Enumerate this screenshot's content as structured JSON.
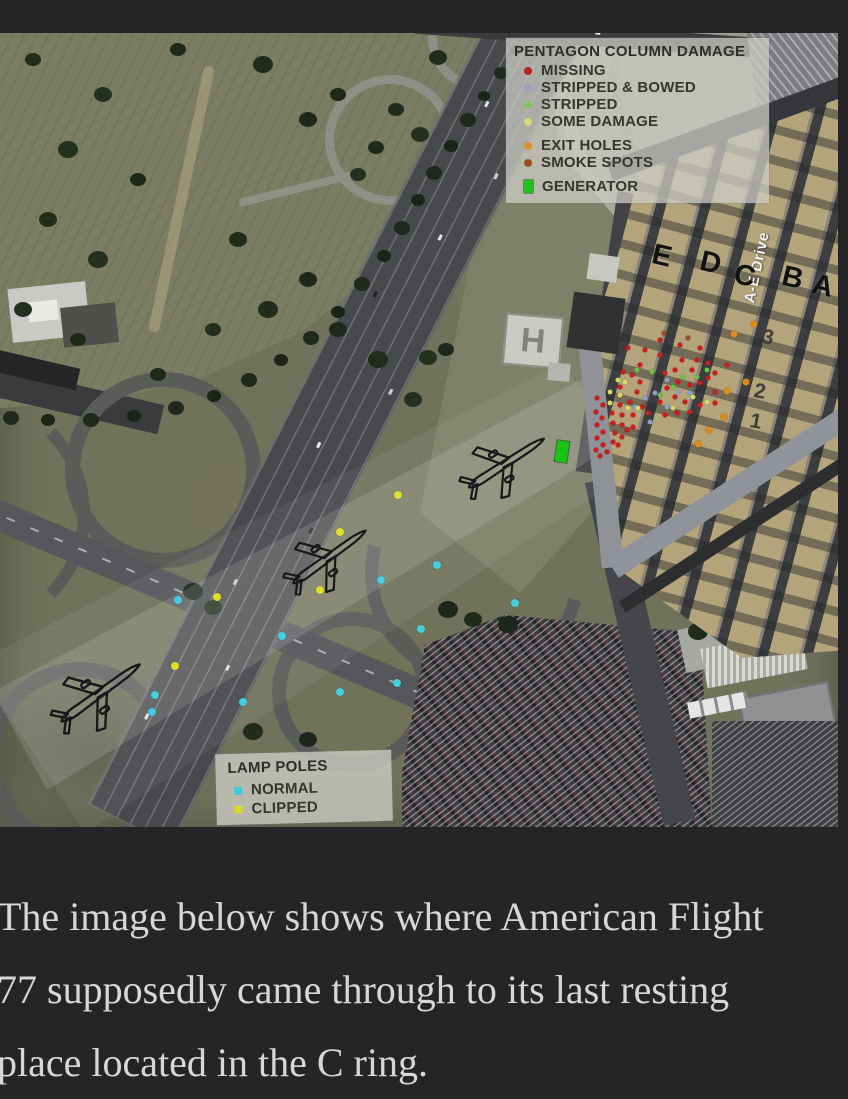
{
  "page": {
    "background": "#262525"
  },
  "figure": {
    "damage_legend": {
      "title": "PENTAGON COLUMN DAMAGE",
      "groups": [
        {
          "items": [
            {
              "label": "MISSING",
              "color": "#bb2026",
              "shape": "circle"
            },
            {
              "label": "STRIPPED & BOWED",
              "color": "#9aa6c0",
              "shape": "circle"
            },
            {
              "label": "STRIPPED",
              "color": "#86c55e",
              "shape": "circle"
            },
            {
              "label": "SOME DAMAGE",
              "color": "#d9d97a",
              "shape": "circle"
            }
          ]
        },
        {
          "items": [
            {
              "label": "EXIT HOLES",
              "color": "#d8912c",
              "shape": "circle"
            },
            {
              "label": "SMOKE SPOTS",
              "color": "#96511f",
              "shape": "circle"
            }
          ]
        },
        {
          "items": [
            {
              "label": "GENERATOR",
              "color": "#1ec41e",
              "shape": "rect"
            }
          ]
        }
      ]
    },
    "lamp_legend": {
      "title": "LAMP POLES",
      "items": [
        {
          "label": "NORMAL",
          "color": "#3ec9d9"
        },
        {
          "label": "CLIPPED",
          "color": "#d8d825"
        }
      ]
    },
    "labels": {
      "rings": [
        {
          "text": "E",
          "x": 652,
          "y": 207
        },
        {
          "text": "D",
          "x": 700,
          "y": 214
        },
        {
          "text": "C",
          "x": 734,
          "y": 227
        },
        {
          "text": "B",
          "x": 782,
          "y": 229
        },
        {
          "text": "A",
          "x": 812,
          "y": 237
        }
      ],
      "drive": "A-E Drive",
      "corridors": [
        {
          "text": "3",
          "x": 762,
          "y": 293
        },
        {
          "text": "2",
          "x": 754,
          "y": 347
        },
        {
          "text": "1",
          "x": 750,
          "y": 377
        }
      ],
      "heliport": "H"
    },
    "overlay": {
      "dot_groups": [
        {
          "name": "missing-column",
          "color": "#cf1d1d",
          "size": 5,
          "shape": "circle",
          "points": [
            [
              628,
              315
            ],
            [
              660,
              322
            ],
            [
              682,
              327
            ],
            [
              697,
              327
            ],
            [
              708,
              330
            ],
            [
              640,
              332
            ],
            [
              623,
              339
            ],
            [
              675,
              337
            ],
            [
              692,
              337
            ],
            [
              727,
              332
            ],
            [
              632,
              342
            ],
            [
              665,
              340
            ],
            [
              708,
              345
            ],
            [
              715,
              340
            ],
            [
              620,
              354
            ],
            [
              637,
              359
            ],
            [
              667,
              355
            ],
            [
              690,
              352
            ],
            [
              700,
              350
            ],
            [
              715,
              359
            ],
            [
              640,
              349
            ],
            [
              678,
              349
            ],
            [
              675,
              364
            ],
            [
              685,
              369
            ],
            [
              660,
              369
            ],
            [
              630,
              369
            ],
            [
              620,
              372
            ],
            [
              642,
              374
            ],
            [
              700,
              372
            ],
            [
              715,
              370
            ],
            [
              612,
              380
            ],
            [
              622,
              382
            ],
            [
              633,
              382
            ],
            [
              648,
              380
            ],
            [
              665,
              382
            ],
            [
              677,
              380
            ],
            [
              690,
              379
            ],
            [
              613,
              390
            ],
            [
              622,
              392
            ],
            [
              633,
              394
            ],
            [
              615,
              400
            ],
            [
              622,
              404
            ],
            [
              613,
              409
            ],
            [
              618,
              412
            ],
            [
              627,
              397
            ],
            [
              597,
              365
            ],
            [
              603,
              372
            ],
            [
              596,
              379
            ],
            [
              602,
              385
            ],
            [
              597,
              392
            ],
            [
              603,
              399
            ],
            [
              597,
              405
            ],
            [
              603,
              412
            ],
            [
              596,
              417
            ],
            [
              600,
              423
            ],
            [
              607,
              419
            ],
            [
              660,
              307
            ],
            [
              680,
              312
            ],
            [
              700,
              315
            ],
            [
              645,
              317
            ]
          ]
        },
        {
          "name": "stripped-bowed-column",
          "color": "#8fa0c8",
          "size": 5,
          "shape": "circle",
          "points": [
            [
              667,
              347
            ],
            [
              690,
              360
            ],
            [
              655,
              360
            ],
            [
              645,
              365
            ],
            [
              678,
              359
            ],
            [
              635,
              374
            ],
            [
              667,
              374
            ],
            [
              650,
              389
            ]
          ]
        },
        {
          "name": "stripped-column",
          "color": "#6fc04a",
          "size": 5,
          "shape": "circle",
          "points": [
            [
              637,
              337
            ],
            [
              652,
              339
            ],
            [
              683,
              344
            ],
            [
              697,
              344
            ],
            [
              673,
              354
            ],
            [
              707,
              337
            ],
            [
              660,
              362
            ]
          ]
        },
        {
          "name": "some-damage-column",
          "color": "#d8d868",
          "size": 5,
          "shape": "circle",
          "points": [
            [
              625,
              349
            ],
            [
              610,
              359
            ],
            [
              620,
              362
            ],
            [
              628,
              375
            ],
            [
              638,
              375
            ],
            [
              673,
              375
            ],
            [
              693,
              364
            ],
            [
              707,
              369
            ],
            [
              610,
              370
            ],
            [
              618,
              347
            ]
          ]
        },
        {
          "name": "exit-hole",
          "color": "#e08a1e",
          "size": 7,
          "shape": "circle",
          "points": [
            [
              754,
              291
            ],
            [
              734,
              301
            ],
            [
              746,
              349
            ],
            [
              727,
              358
            ],
            [
              724,
              384
            ],
            [
              709,
              397
            ],
            [
              698,
              411
            ]
          ]
        },
        {
          "name": "smoke-spot",
          "color": "#96511f",
          "size": 5,
          "shape": "circle",
          "points": [
            [
              664,
              300
            ],
            [
              688,
              305
            ]
          ]
        },
        {
          "name": "lamp-pole-normal",
          "color": "#45cedd",
          "size": 8,
          "shape": "circle",
          "points": [
            [
              178,
              567
            ],
            [
              155,
              662
            ],
            [
              152,
              679
            ],
            [
              243,
              669
            ],
            [
              282,
              603
            ],
            [
              340,
              659
            ],
            [
              397,
              650
            ],
            [
              421,
              596
            ],
            [
              381,
              547
            ],
            [
              437,
              532
            ],
            [
              515,
              570
            ]
          ]
        },
        {
          "name": "lamp-pole-clipped",
          "color": "#e0e02a",
          "size": 8,
          "shape": "circle",
          "points": [
            [
              398,
              462
            ],
            [
              340,
              499
            ],
            [
              320,
              557
            ],
            [
              217,
              564
            ],
            [
              175,
              633
            ]
          ]
        }
      ],
      "generator": {
        "color": "#19c419",
        "x": 556,
        "y": 408,
        "w": 12,
        "h": 21
      },
      "planes": [
        {
          "x": 99,
          "y": 661,
          "deg": -36,
          "w": 108
        },
        {
          "x": 328,
          "y": 525,
          "deg": -36,
          "w": 100
        },
        {
          "x": 505,
          "y": 431,
          "deg": -33,
          "w": 100
        }
      ]
    }
  },
  "caption": {
    "lines": [
      "The image below shows where American Flight",
      "77 supposedly came through to its last resting",
      "place located in the C ring."
    ]
  }
}
